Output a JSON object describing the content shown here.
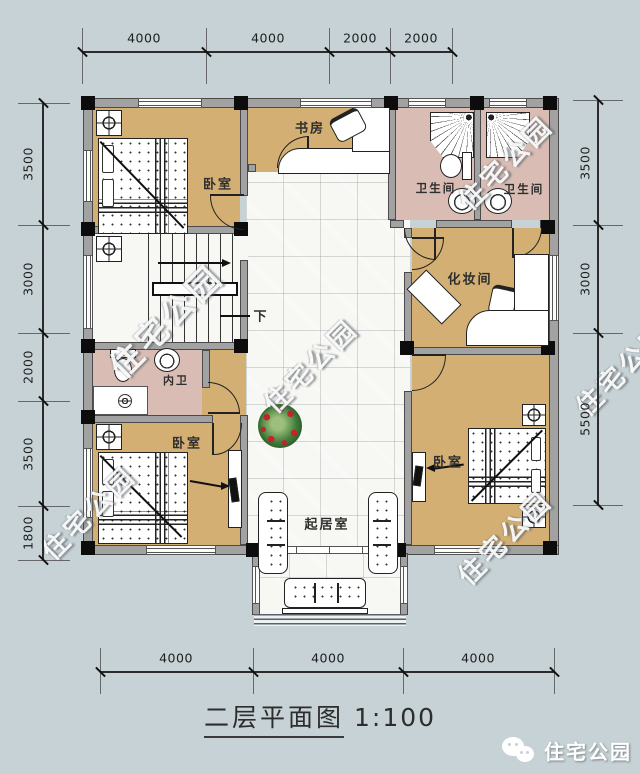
{
  "colors": {
    "bg": "#c6d2d6",
    "tan": "#d4af74",
    "pink": "#d9bdb4",
    "wall": "#a2a2a2",
    "whitefloor": "#f7f7f3",
    "wreathgreen": "#3f7a3a",
    "wreathred": "#c0262b"
  },
  "title": {
    "name": "二层平面图",
    "scale": "1:100"
  },
  "brand": {
    "label": "住宅公园",
    "icon": "wechat-icon"
  },
  "watermark": {
    "text": "住宅公园"
  },
  "dimensions": {
    "top": [
      "4000",
      "4000",
      "2000",
      "2000"
    ],
    "bottom": [
      "4000",
      "4000",
      "4000"
    ],
    "left": [
      "3500",
      "3000",
      "2000",
      "3500",
      "1800"
    ],
    "right": [
      "3500",
      "3000",
      "5500"
    ]
  },
  "rooms": {
    "bedroom_tl": "卧室",
    "study": "书房",
    "bath_left": "卫生间",
    "bath_right": "卫生间",
    "dressing": "化妆间",
    "inner_bath": "内卫",
    "bedroom_bl": "卧室",
    "bedroom_br": "卧室",
    "living": "起居室",
    "stairs_down": "下"
  }
}
